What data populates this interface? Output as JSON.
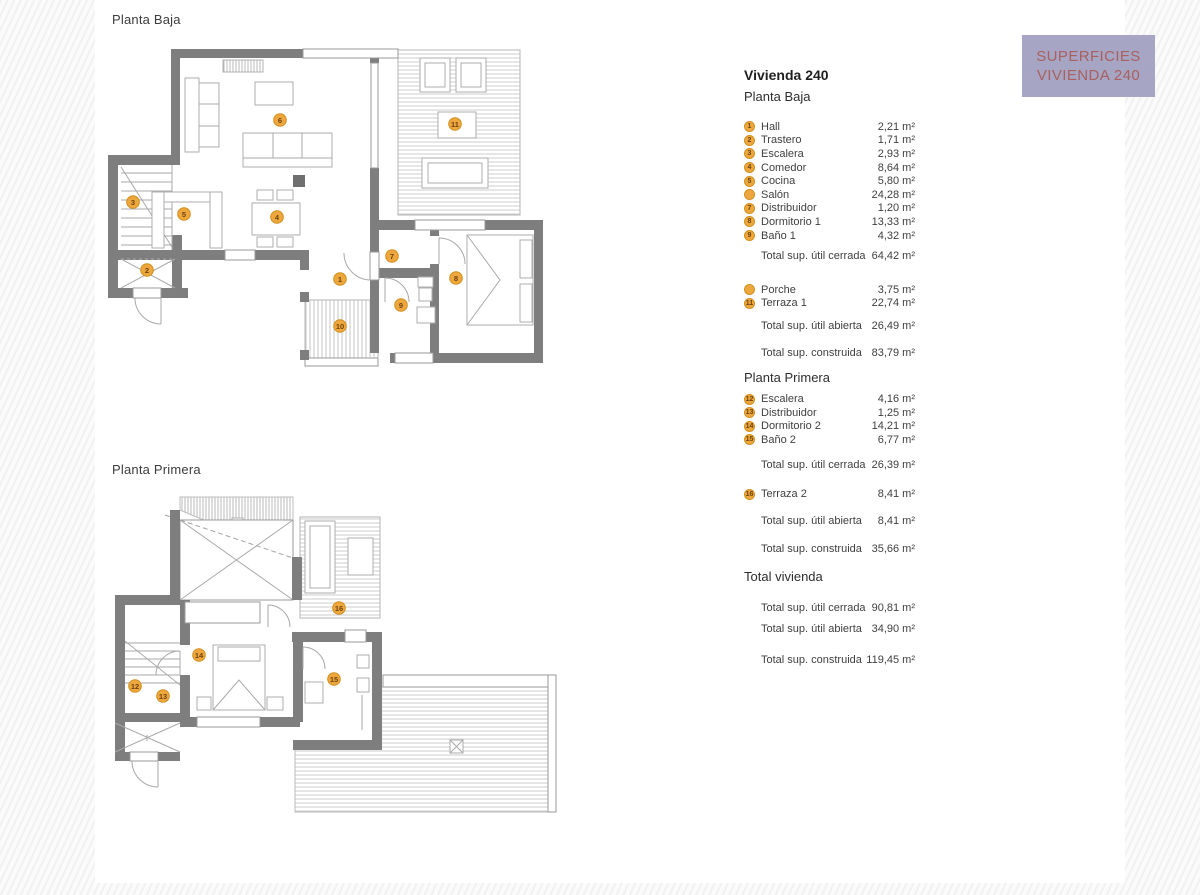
{
  "banner": {
    "line1": "SUPERFICIES",
    "line2": "VIVIENDA 240",
    "bg_color": "#a6a5c4",
    "text_color": "#a9605f"
  },
  "plan_titles": {
    "baja": "Planta Baja",
    "primera": "Planta Primera"
  },
  "colors": {
    "wall": "#7e7e7e",
    "marker_fill": "#eda73d",
    "marker_text": "#6d4310",
    "page": "#ffffff"
  },
  "legend": {
    "title": "Vivienda 240",
    "sections": [
      {
        "heading": "Planta Baja",
        "rooms": [
          {
            "num": "1",
            "badge": "1",
            "label": "Hall",
            "value": "2,21 m²"
          },
          {
            "num": "2",
            "badge": "2",
            "label": "Trastero",
            "value": "1,71 m²"
          },
          {
            "num": "3",
            "badge": "3",
            "label": "Escalera",
            "value": "2,93 m²"
          },
          {
            "num": "4",
            "badge": "4",
            "label": "Comedor",
            "value": "8,64 m²"
          },
          {
            "num": "5",
            "badge": "5",
            "label": "Cocina",
            "value": "5,80 m²"
          },
          {
            "num": "6",
            "badge": "",
            "label": "Salón",
            "value": "24,28 m²"
          },
          {
            "num": "7",
            "badge": "7",
            "label": "Distribuidor",
            "value": "1,20 m²"
          },
          {
            "num": "8",
            "badge": "8",
            "label": "Dormitorio 1",
            "value": "13,33 m²"
          },
          {
            "num": "9",
            "badge": "9",
            "label": "Baño 1",
            "value": "4,32 m²"
          }
        ],
        "total_cerrada": {
          "label": "Total sup. útil cerrada",
          "value": "64,42 m²"
        },
        "open_rooms": [
          {
            "num": "10",
            "badge": "",
            "label": "Porche",
            "value": "3,75 m²"
          },
          {
            "num": "11",
            "badge": "11",
            "label": "Terraza 1",
            "value": "22,74 m²"
          }
        ],
        "total_abierta": {
          "label": "Total sup. útil abierta",
          "value": "26,49 m²"
        },
        "total_construida": {
          "label": "Total sup. construida",
          "value": "83,79 m²"
        }
      },
      {
        "heading": "Planta Primera",
        "rooms": [
          {
            "num": "12",
            "badge": "12",
            "label": "Escalera",
            "value": "4,16 m²"
          },
          {
            "num": "13",
            "badge": "13",
            "label": "Distribuidor",
            "value": "1,25 m²"
          },
          {
            "num": "14",
            "badge": "14",
            "label": "Dormitorio 2",
            "value": "14,21 m²"
          },
          {
            "num": "15",
            "badge": "15",
            "label": "Baño 2",
            "value": "6,77 m²"
          }
        ],
        "total_cerrada": {
          "label": "Total sup. útil cerrada",
          "value": "26,39 m²"
        },
        "open_rooms": [
          {
            "num": "16",
            "badge": "16",
            "label": "Terraza 2",
            "value": "8,41 m²"
          }
        ],
        "total_abierta": {
          "label": "Total sup. útil abierta",
          "value": "8,41 m²"
        },
        "total_construida": {
          "label": "Total sup. construida",
          "value": "35,66 m²"
        }
      }
    ],
    "total_vivienda": {
      "heading": "Total vivienda",
      "rows": [
        {
          "label": "Total sup. útil cerrada",
          "value": "90,81 m²"
        },
        {
          "label": "Total sup. útil abierta",
          "value": "34,90 m²"
        },
        {
          "label": "Total sup. construida",
          "value": "119,45 m²"
        }
      ]
    }
  }
}
